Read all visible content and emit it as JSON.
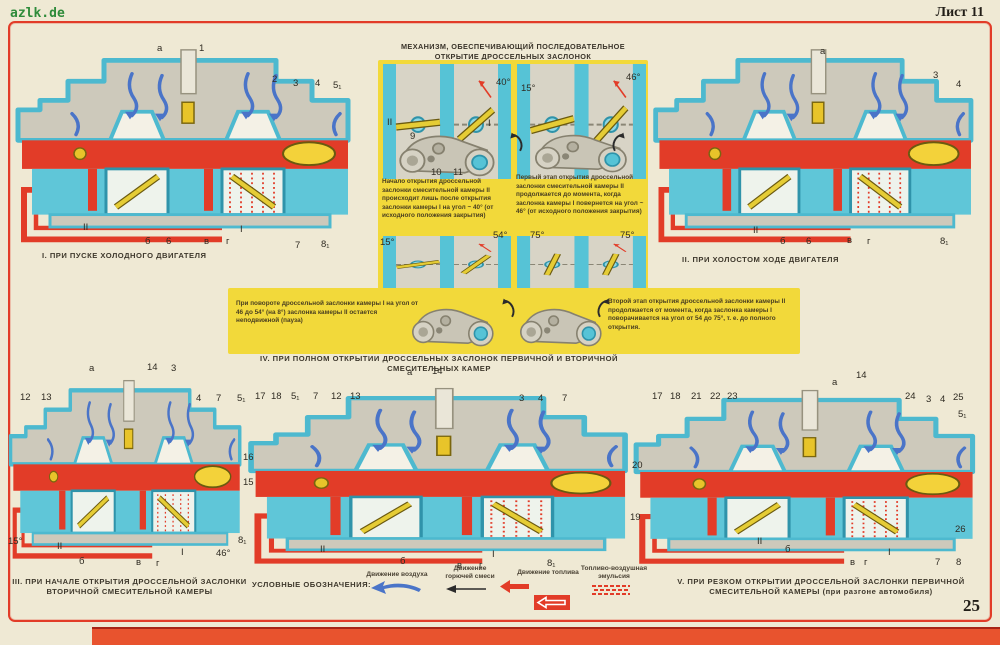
{
  "page": {
    "watermark": "azlk.de",
    "sheet_label": "Лист 11",
    "page_number": "25"
  },
  "colors": {
    "paper": "#efe9d4",
    "frame_red": "#e23c28",
    "panel_yellow": "#f2d93a",
    "body_cyan": "#56c3d6",
    "body_gray": "#cdc9bb",
    "air_blue": "#4a74c8",
    "brass_yellow": "#e8c42a"
  },
  "mechanism": {
    "title_line1": "МЕХАНИЗМ, ОБЕСПЕЧИВАЮЩИЙ ПОСЛЕДОВАТЕЛЬНОЕ",
    "title_line2": "ОТКРЫТИЕ ДРОССЕЛЬНЫХ ЗАСЛОНОК",
    "text_stage1_start": "Начало открытия дроссельной заслонки смесительной камеры II происходит лишь после открытия заслонки камеры I на угол ~ 40° (от исходного положения закрытия)",
    "text_stage1_end": "Первый этап открытия дроссельной заслонки смесительной камеры II продолжается до момента, когда заслонка камеры I повернется на угол ~ 46° (от исходного положения закрытия)",
    "text_pause": "При повороте дроссельной заслонки камеры I на угол от 46 до 54° (на 8°) заслонка камеры II остается неподвижной (пауза)",
    "text_stage2": "Второй этап открытия дроссельной заслонки камеры II продолжается от момента, когда заслонка камеры I поворачивается на угол от 54 до 75°, т. е. до полного открытия.",
    "callouts": [
      {
        "t": "II",
        "x": 9,
        "y": 75
      },
      {
        "t": "I",
        "x": 110,
        "y": 76
      },
      {
        "t": "40°",
        "x": 118,
        "y": 35
      },
      {
        "t": "15°",
        "x": 143,
        "y": 41
      },
      {
        "t": "46°",
        "x": 248,
        "y": 30
      },
      {
        "t": "9",
        "x": 32,
        "y": 89
      },
      {
        "t": "10",
        "x": 53,
        "y": 125
      },
      {
        "t": "11",
        "x": 75,
        "y": 125
      },
      {
        "t": "15°",
        "x": 2,
        "y": 195
      },
      {
        "t": "54°",
        "x": 115,
        "y": 188
      },
      {
        "t": "75°",
        "x": 152,
        "y": 188
      },
      {
        "t": "75°",
        "x": 242,
        "y": 188
      }
    ]
  },
  "captions": {
    "c1": "I. ПРИ ПУСКЕ ХОЛОДНОГО ДВИГАТЕЛЯ",
    "c2": "II. ПРИ ХОЛОСТОМ ХОДЕ ДВИГАТЕЛЯ",
    "c3": "III. ПРИ НАЧАЛЕ ОТКРЫТИЯ ДРОССЕЛЬНОЙ ЗАСЛОНКИ\nВТОРИЧНОЙ СМЕСИТЕЛЬНОЙ КАМЕРЫ",
    "c4": "IV. ПРИ ПОЛНОМ ОТКРЫТИИ ДРОССЕЛЬНЫХ ЗАСЛОНОК ПЕРВИЧНОЙ И ВТОРИЧНОЙ СМЕСИТЕЛЬНЫХ КАМЕР",
    "c5": "V. ПРИ РЕЗКОМ ОТКРЫТИИ ДРОССЕЛЬНОЙ ЗАСЛОНКИ ПЕРВИЧНОЙ\nСМЕСИТЕЛЬНОЙ КАМЕРЫ (при разгоне автомобиля)"
  },
  "legend": {
    "title": "УСЛОВНЫЕ ОБОЗНАЧЕНИЯ:",
    "items": [
      {
        "label": "Движение воздуха"
      },
      {
        "label": "Движение горючей смеси"
      },
      {
        "label": "Движение топлива"
      },
      {
        "label": "Топливо-воздушная эмульсия"
      }
    ]
  },
  "diagrams": {
    "d1": {
      "callouts": [
        {
          "t": "а",
          "x": 147,
          "y": 8
        },
        {
          "t": "1",
          "x": 189,
          "y": 8
        },
        {
          "t": "2",
          "x": 262,
          "y": 39
        },
        {
          "t": "3",
          "x": 283,
          "y": 43
        },
        {
          "t": "4",
          "x": 305,
          "y": 43
        },
        {
          "t": "5₁",
          "x": 323,
          "y": 45
        },
        {
          "t": "II",
          "x": 73,
          "y": 187
        },
        {
          "t": "б",
          "x": 135,
          "y": 201
        },
        {
          "t": "6",
          "x": 156,
          "y": 201
        },
        {
          "t": "в",
          "x": 194,
          "y": 201
        },
        {
          "t": "г",
          "x": 216,
          "y": 201
        },
        {
          "t": "I",
          "x": 230,
          "y": 189
        },
        {
          "t": "7",
          "x": 285,
          "y": 205
        },
        {
          "t": "8₁",
          "x": 311,
          "y": 204
        }
      ]
    },
    "d2": {
      "callouts": [
        {
          "t": "а",
          "x": 172,
          "y": 11
        },
        {
          "t": "3",
          "x": 285,
          "y": 35
        },
        {
          "t": "4",
          "x": 308,
          "y": 44
        },
        {
          "t": "II",
          "x": 105,
          "y": 190
        },
        {
          "t": "б",
          "x": 132,
          "y": 201
        },
        {
          "t": "6",
          "x": 158,
          "y": 201
        },
        {
          "t": "в",
          "x": 199,
          "y": 200
        },
        {
          "t": "г",
          "x": 219,
          "y": 201
        },
        {
          "t": "8₁",
          "x": 292,
          "y": 201
        }
      ]
    },
    "d3": {
      "callouts": [
        {
          "t": "а",
          "x": 84,
          "y": 3
        },
        {
          "t": "14",
          "x": 142,
          "y": 2
        },
        {
          "t": "3",
          "x": 166,
          "y": 3
        },
        {
          "t": "12",
          "x": 15,
          "y": 32
        },
        {
          "t": "13",
          "x": 36,
          "y": 32
        },
        {
          "t": "4",
          "x": 191,
          "y": 33
        },
        {
          "t": "7",
          "x": 211,
          "y": 33
        },
        {
          "t": "5₁",
          "x": 232,
          "y": 33
        },
        {
          "t": "15°",
          "x": 3,
          "y": 176
        },
        {
          "t": "II",
          "x": 52,
          "y": 181
        },
        {
          "t": "б",
          "x": 74,
          "y": 196
        },
        {
          "t": "в",
          "x": 131,
          "y": 197
        },
        {
          "t": "г",
          "x": 151,
          "y": 198
        },
        {
          "t": "I",
          "x": 176,
          "y": 187
        },
        {
          "t": "46°",
          "x": 211,
          "y": 188
        },
        {
          "t": "8₁",
          "x": 233,
          "y": 175
        }
      ]
    },
    "d4": {
      "callouts": [
        {
          "t": "17",
          "x": 13,
          "y": 25
        },
        {
          "t": "18",
          "x": 29,
          "y": 25
        },
        {
          "t": "5₁",
          "x": 49,
          "y": 25
        },
        {
          "t": "7",
          "x": 71,
          "y": 25
        },
        {
          "t": "12",
          "x": 89,
          "y": 25
        },
        {
          "t": "13",
          "x": 108,
          "y": 25
        },
        {
          "t": "а",
          "x": 165,
          "y": 1
        },
        {
          "t": "14",
          "x": 190,
          "y": 0
        },
        {
          "t": "3",
          "x": 277,
          "y": 27
        },
        {
          "t": "4",
          "x": 296,
          "y": 27
        },
        {
          "t": "7",
          "x": 320,
          "y": 27
        },
        {
          "t": "16",
          "x": 1,
          "y": 86
        },
        {
          "t": "15",
          "x": 1,
          "y": 111
        },
        {
          "t": "II",
          "x": 78,
          "y": 178
        },
        {
          "t": "б",
          "x": 158,
          "y": 190
        },
        {
          "t": "в",
          "x": 215,
          "y": 194
        },
        {
          "t": "г",
          "x": 237,
          "y": 194
        },
        {
          "t": "I",
          "x": 250,
          "y": 183
        },
        {
          "t": "8₁",
          "x": 305,
          "y": 192
        }
      ]
    },
    "d5": {
      "callouts": [
        {
          "t": "17",
          "x": 24,
          "y": 21
        },
        {
          "t": "18",
          "x": 42,
          "y": 21
        },
        {
          "t": "21",
          "x": 63,
          "y": 21
        },
        {
          "t": "22",
          "x": 82,
          "y": 21
        },
        {
          "t": "23",
          "x": 99,
          "y": 21
        },
        {
          "t": "а",
          "x": 204,
          "y": 7
        },
        {
          "t": "14",
          "x": 228,
          "y": 0
        },
        {
          "t": "24",
          "x": 277,
          "y": 21
        },
        {
          "t": "3",
          "x": 298,
          "y": 24
        },
        {
          "t": "4",
          "x": 312,
          "y": 24
        },
        {
          "t": "25",
          "x": 325,
          "y": 22
        },
        {
          "t": "5₁",
          "x": 330,
          "y": 39
        },
        {
          "t": "20",
          "x": 4,
          "y": 90
        },
        {
          "t": "19",
          "x": 2,
          "y": 142
        },
        {
          "t": "26",
          "x": 327,
          "y": 154
        },
        {
          "t": "II",
          "x": 129,
          "y": 166
        },
        {
          "t": "б",
          "x": 157,
          "y": 174
        },
        {
          "t": "в",
          "x": 222,
          "y": 187
        },
        {
          "t": "г",
          "x": 236,
          "y": 187
        },
        {
          "t": "I",
          "x": 260,
          "y": 177
        },
        {
          "t": "7",
          "x": 307,
          "y": 187
        },
        {
          "t": "8",
          "x": 328,
          "y": 187
        }
      ]
    }
  }
}
